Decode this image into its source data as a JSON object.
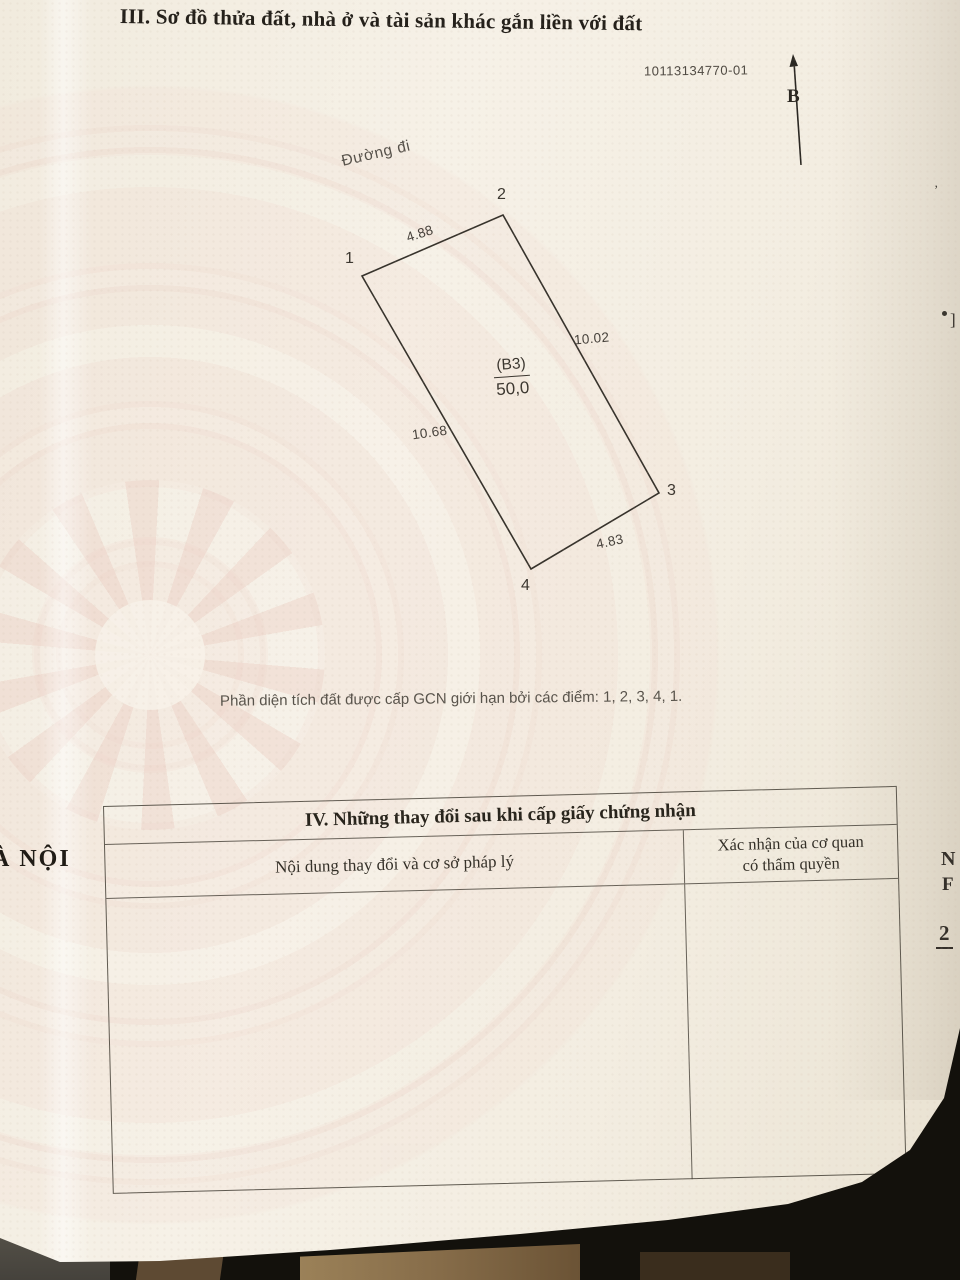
{
  "document": {
    "section3": {
      "title": "III. Sơ đồ thửa đất, nhà ở và tài sản khác gắn liền với đất",
      "sheet_number": "10113134770-01",
      "north_label": "B",
      "road_label": "Đường đi",
      "caption": "Phần diện tích đất được cấp GCN giới hạn bởi các điểm: 1, 2, 3, 4, 1.",
      "parcel": {
        "code": "(B3)",
        "area": "50,0",
        "polygon_points": "362,276 503,215 659,493 531,569",
        "corners": [
          {
            "id": "1"
          },
          {
            "id": "2"
          },
          {
            "id": "3"
          },
          {
            "id": "4"
          }
        ],
        "sides": [
          {
            "from": "1",
            "to": "2",
            "length": "4.88"
          },
          {
            "from": "2",
            "to": "3",
            "length": "10.02"
          },
          {
            "from": "1",
            "to": "4",
            "length": "10.68"
          },
          {
            "from": "4",
            "to": "3",
            "length": "4.83"
          }
        ]
      }
    },
    "section4": {
      "title": "IV. Những thay đổi sau khi cấp giấy chứng nhận",
      "columns": [
        {
          "header": "Nội dung thay đổi và cơ sở pháp lý"
        },
        {
          "header_line1": "Xác nhận của cơ quan",
          "header_line2": "có thẩm quyền"
        }
      ],
      "rows": []
    },
    "edge_text": {
      "left_partial": "À NỘI",
      "right_partial_1": "N",
      "right_partial_2": "F",
      "right_partial_3": "2",
      "right_partial_4": "]",
      "right_partial_5": "’"
    },
    "colors": {
      "paper": "#f4eee2",
      "pattern_pink": "#eccfc6",
      "ink": "#24201a",
      "diagram_line": "#37332c",
      "photo_background": "#13110c",
      "wood": "#866c49"
    }
  }
}
